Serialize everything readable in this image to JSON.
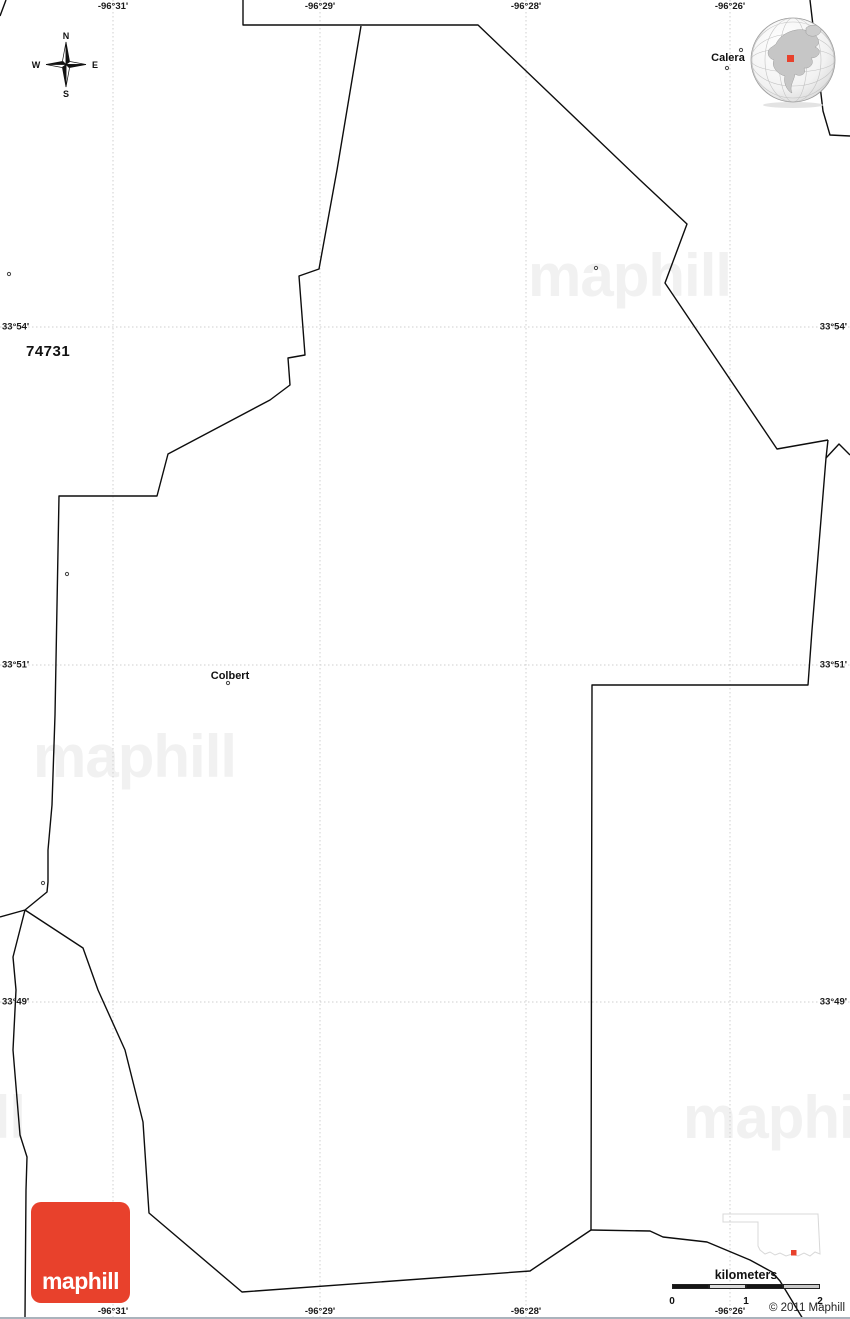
{
  "map_title_zip": "74731",
  "copyright": "© 2011 Maphill",
  "logo": {
    "text": "maphill",
    "bg_color": "#e8412c"
  },
  "watermark": {
    "text": "maphill",
    "color": "#f1f1f1",
    "positions": [
      {
        "left": 528,
        "top": 246
      },
      {
        "left": 33,
        "top": 727
      },
      {
        "left": -178,
        "top": 1088
      },
      {
        "left": 683,
        "top": 1088
      }
    ]
  },
  "compass": {
    "n": "N",
    "e": "E",
    "s": "S",
    "w": "W"
  },
  "scale_bar": {
    "title": "kilometers",
    "x": 672,
    "y_bar": 15,
    "segment_width": 37,
    "height": 5,
    "segment_colors": [
      "#151515",
      "#dcdcdc",
      "#151515",
      "#c9c9c9"
    ],
    "ticks": [
      {
        "label": "0",
        "offset": 0
      },
      {
        "label": "1",
        "offset": 74
      },
      {
        "label": "2",
        "offset": 148
      }
    ]
  },
  "grid": {
    "line_color": "#cfcfcf",
    "meridians": [
      {
        "text": "-96°31'",
        "x": 113
      },
      {
        "text": "-96°29'",
        "x": 320
      },
      {
        "text": "-96°28'",
        "x": 526
      },
      {
        "text": "-96°26'",
        "x": 730
      }
    ],
    "parallels": [
      {
        "text": "33°54'",
        "y": 327
      },
      {
        "text": "33°51'",
        "y": 665
      },
      {
        "text": "33°49'",
        "y": 1002
      }
    ]
  },
  "places": [
    {
      "name": "Colbert",
      "x": 230,
      "y": 676,
      "dot": [
        228,
        683
      ]
    },
    {
      "name": "Calera",
      "x": 728,
      "y": 58,
      "dot": [
        727,
        68
      ]
    }
  ],
  "locator_globe": {
    "marker_color": "#e8412c"
  },
  "inset_state": {
    "marker_color": "#e8412c"
  },
  "map_geometry": {
    "line_color": "#0d0d0d",
    "boundary_segments": [
      [
        [
          0,
          16
        ],
        [
          6,
          0
        ]
      ],
      [
        [
          243,
          0
        ],
        [
          243,
          25
        ],
        [
          478,
          25
        ],
        [
          640,
          180
        ],
        [
          687,
          224
        ],
        [
          665,
          283
        ],
        [
          777,
          449
        ],
        [
          828,
          440
        ]
      ],
      [
        [
          828,
          440
        ],
        [
          826,
          458
        ],
        [
          812,
          630
        ],
        [
          808,
          685
        ],
        [
          592,
          685
        ],
        [
          591,
          1230
        ]
      ],
      [
        [
          826,
          458
        ],
        [
          839,
          444
        ],
        [
          850,
          455
        ]
      ],
      [
        [
          810,
          0
        ],
        [
          823,
          111
        ],
        [
          830,
          135
        ],
        [
          850,
          136
        ]
      ],
      [
        [
          591,
          1230
        ],
        [
          530,
          1271
        ],
        [
          242,
          1292
        ],
        [
          149,
          1213
        ],
        [
          143,
          1122
        ],
        [
          125,
          1050
        ],
        [
          98,
          990
        ],
        [
          83,
          948
        ],
        [
          25,
          910
        ]
      ],
      [
        [
          591,
          1230
        ],
        [
          650,
          1231
        ],
        [
          663,
          1237
        ],
        [
          707,
          1242
        ],
        [
          750,
          1260
        ],
        [
          772,
          1272
        ],
        [
          780,
          1281
        ],
        [
          803,
          1319
        ]
      ],
      [
        [
          25,
          910
        ],
        [
          0,
          917
        ]
      ],
      [
        [
          25,
          910
        ],
        [
          13,
          957
        ],
        [
          16,
          990
        ],
        [
          13,
          1050
        ],
        [
          20,
          1135
        ],
        [
          27,
          1157
        ],
        [
          26,
          1190
        ],
        [
          25,
          1317
        ]
      ],
      [
        [
          25,
          910
        ],
        [
          47,
          892
        ],
        [
          48,
          882
        ],
        [
          48,
          850
        ],
        [
          52,
          805
        ],
        [
          55,
          715
        ],
        [
          59,
          496
        ],
        [
          157,
          496
        ],
        [
          168,
          454
        ],
        [
          270,
          400
        ],
        [
          290,
          385
        ],
        [
          288,
          358
        ],
        [
          305,
          355
        ],
        [
          299,
          276
        ],
        [
          319,
          269
        ],
        [
          337,
          170
        ],
        [
          361,
          26
        ]
      ]
    ],
    "point_markers": [
      [
        9,
        274
      ],
      [
        67,
        574
      ],
      [
        43,
        883
      ],
      [
        596,
        268
      ],
      [
        741,
        50
      ]
    ]
  }
}
